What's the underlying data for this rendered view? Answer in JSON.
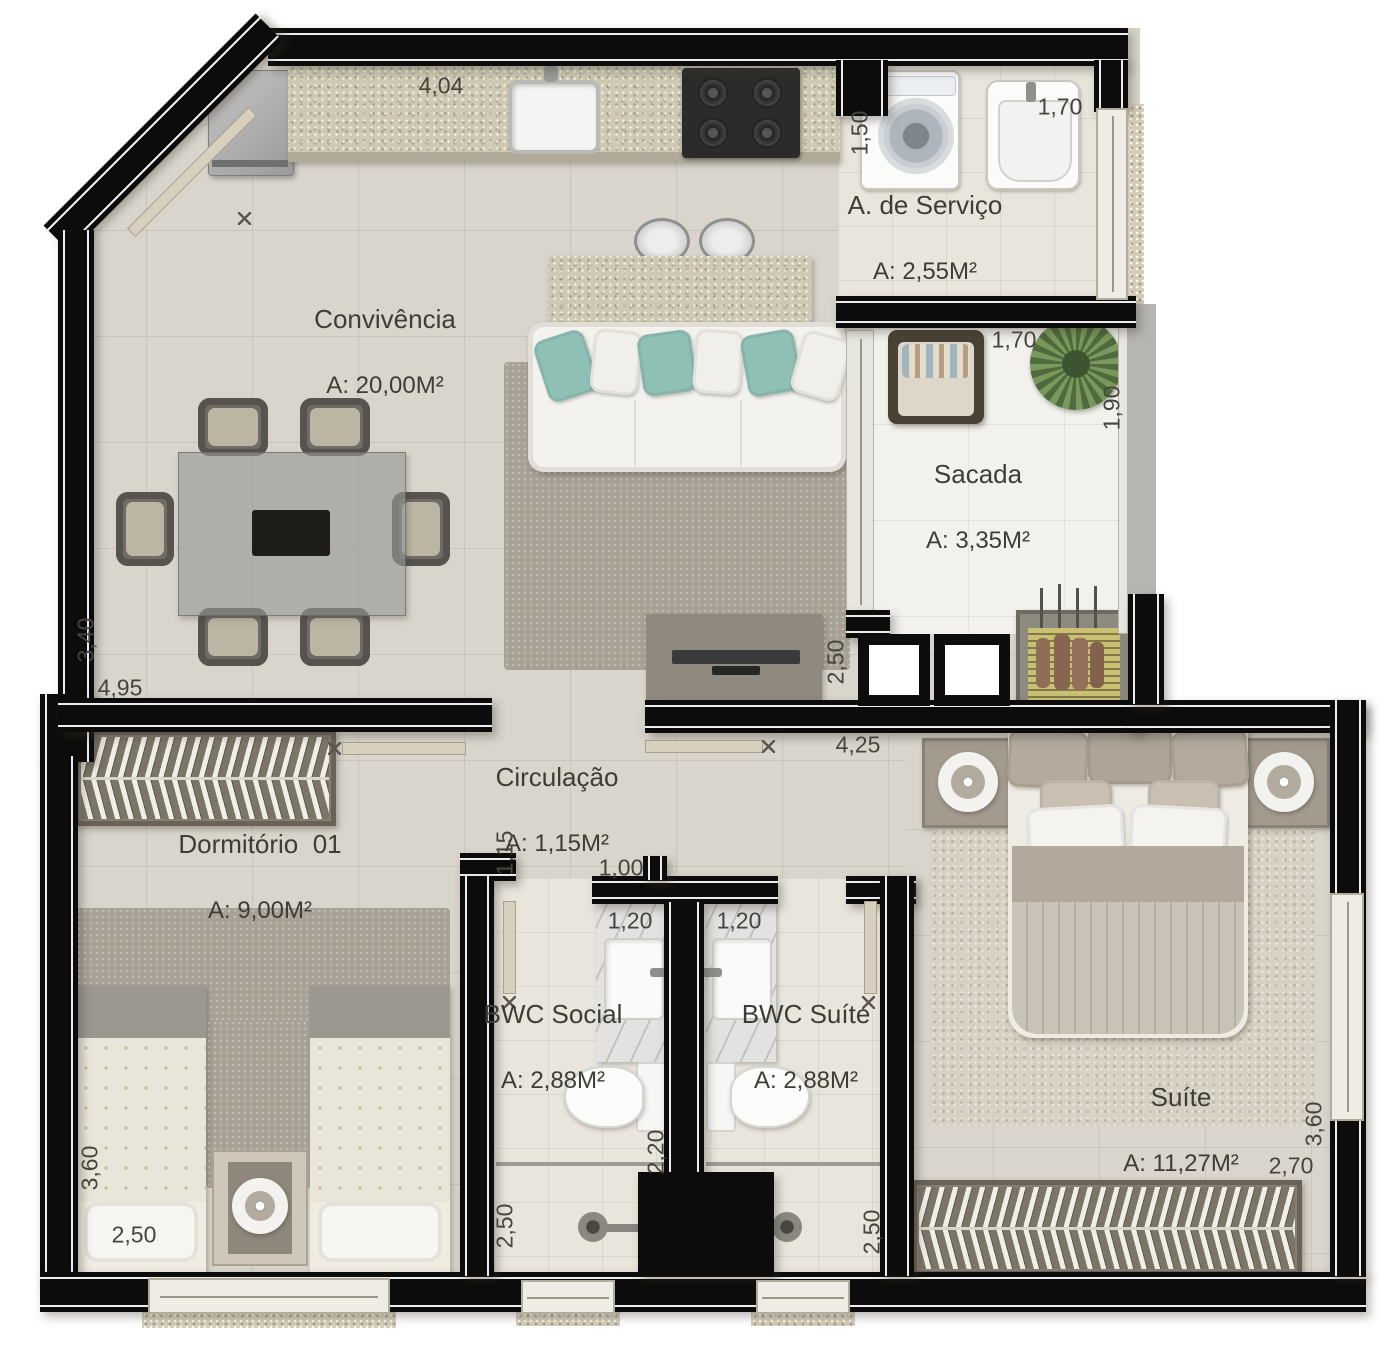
{
  "rooms": {
    "convivencia": {
      "name": "Convivência",
      "area": "A: 20,00M²"
    },
    "servico": {
      "name": "A. de Serviço",
      "area": "A: 2,55M²"
    },
    "sacada": {
      "name": "Sacada",
      "area": "A: 3,35M²"
    },
    "circulacao": {
      "name": "Circulação",
      "area": "A: 1,15M²"
    },
    "dormitorio": {
      "name": "Dormitório  01",
      "area": "A: 9,00M²"
    },
    "bwcSocial": {
      "name": "BWC Social",
      "area": "A: 2,88M²"
    },
    "bwcSuite": {
      "name": "BWC Suíte",
      "area": "A: 2,88M²"
    },
    "suite": {
      "name": "Suíte",
      "area": "A: 11,27M²"
    }
  },
  "dims": {
    "kitchenCounter": "4,04",
    "servicoOpening": "1,50",
    "servicoTank": "1,70",
    "sacadaWidth": "1,70",
    "sacadaDepth": "1,90",
    "tvWall": "2,50",
    "hallSpan": "4,25",
    "livingDepth": "3,40",
    "livingWidth": "4,95",
    "circWidth": "1,15",
    "bwcDoor": "1,00",
    "bwcSocialSink": "1,20",
    "bwcSuiteSink": "1,20",
    "dormDepth": "3,60",
    "dormBed": "2,50",
    "bwcSocialDepth": "2,50",
    "bwcSuiteDepth": "2,50",
    "bwcDivider": "2,20",
    "suiteWidth": "2,70",
    "suiteDepth": "3,60"
  },
  "palette": {
    "wall": "#0c0c0c",
    "floor": "#d9d5cc",
    "balconyFloor": "#f2f1ed",
    "granite": "#cfc8b2",
    "tealPillow": "#8fc0b6",
    "plantGreen": "#55713f",
    "grillYellow": "#c9c073",
    "labelText": "#3e3c36"
  }
}
